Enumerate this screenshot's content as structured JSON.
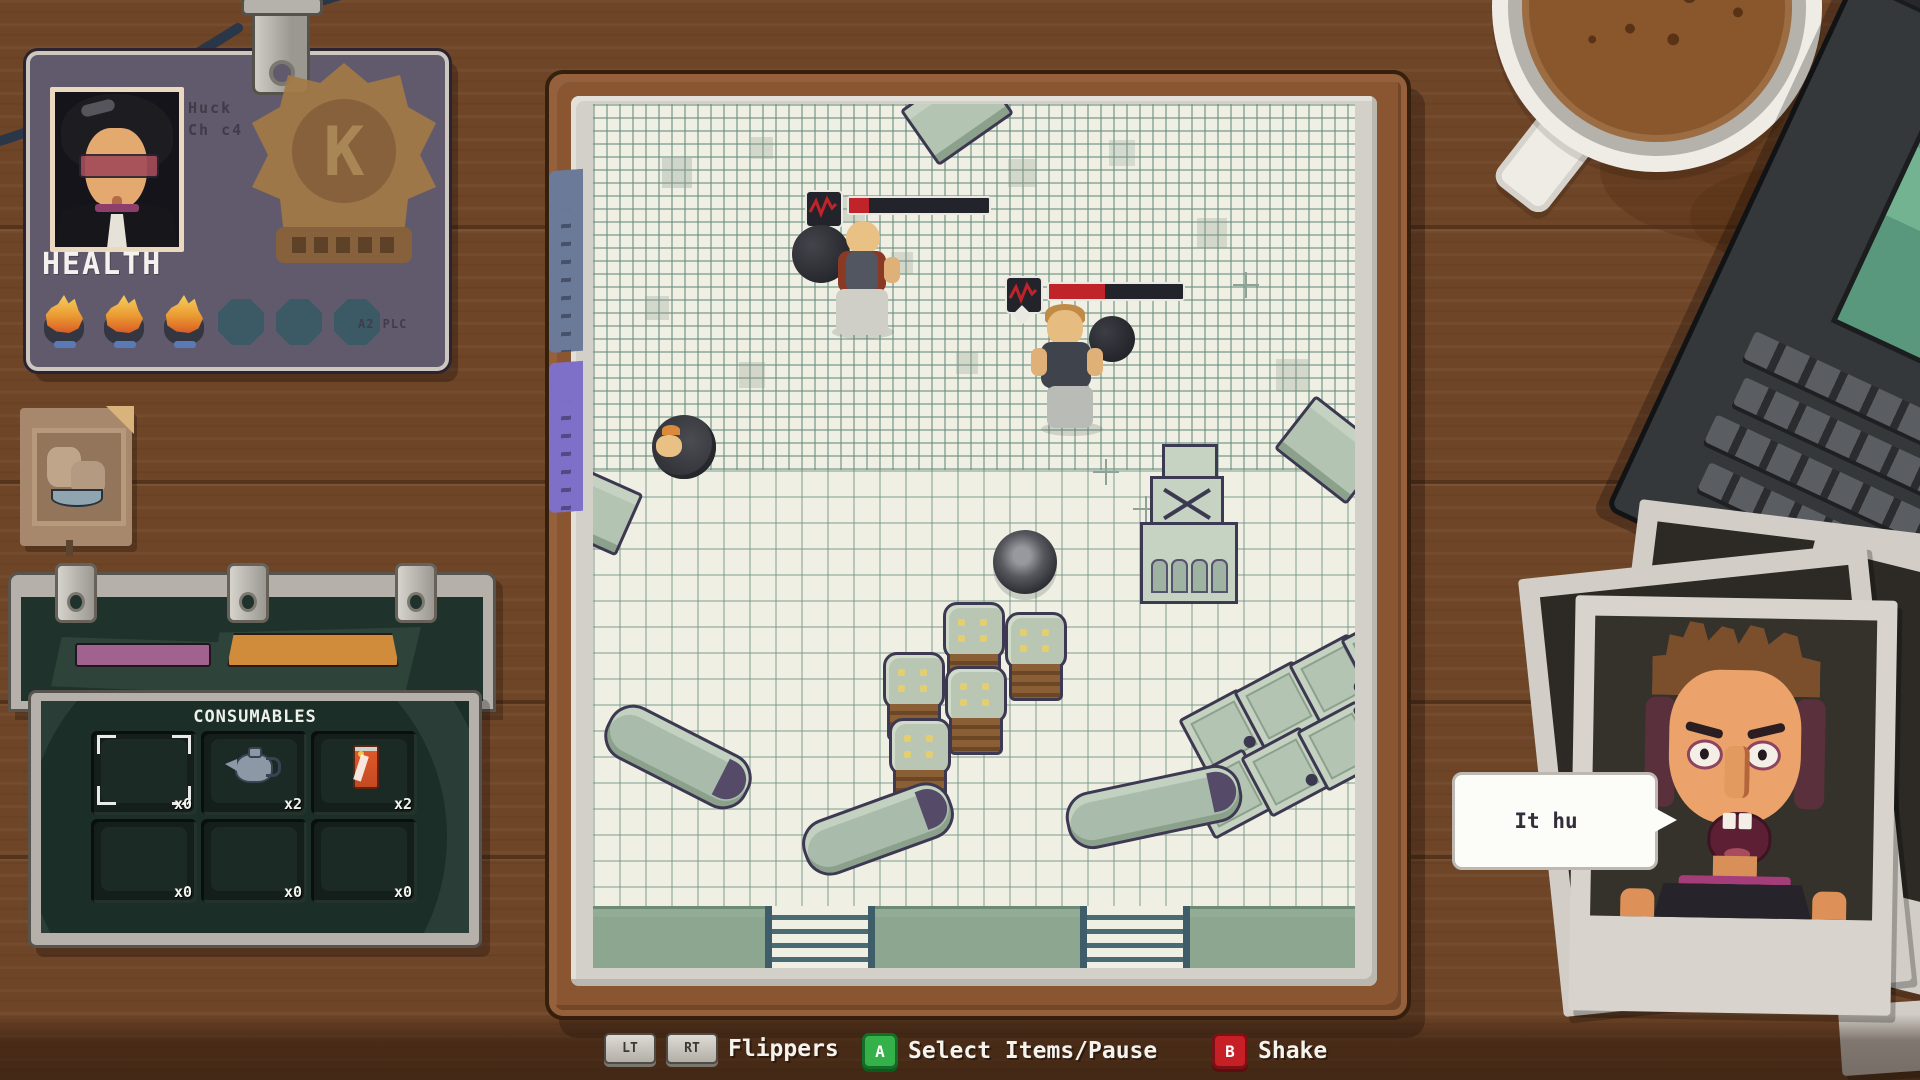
{
  "badge": {
    "name_line1": "Huck",
    "name_line2": "Ch c4",
    "health_label": "HEALTH",
    "health_current": 3,
    "health_max": 6,
    "footer_text": "A2 PLC",
    "emblem_letter": "K"
  },
  "consumables": {
    "title": "CONSUMABLES",
    "slots": [
      {
        "item": "empty",
        "selected": true,
        "count_label": "x0"
      },
      {
        "item": "kettle",
        "selected": false,
        "count_label": "x2"
      },
      {
        "item": "soda-can",
        "selected": false,
        "count_label": "x2"
      },
      {
        "item": "empty",
        "selected": false,
        "count_label": "x0"
      },
      {
        "item": "empty",
        "selected": false,
        "count_label": "x0"
      },
      {
        "item": "empty",
        "selected": false,
        "count_label": "x0"
      }
    ]
  },
  "board": {
    "surface": "graph-paper",
    "enemies": [
      {
        "name": "bald-brawler-with-flail",
        "health_pct": 14
      },
      {
        "name": "blond-brawler-with-ball",
        "health_pct": 42
      }
    ],
    "props": [
      "rolled-enemy-ball",
      "cannonball",
      "crate-tower",
      "barrel-stack",
      "crate-staircase",
      "flippers",
      "ladders",
      "bottom-ledge"
    ]
  },
  "speech": {
    "text": "It hu"
  },
  "controls": {
    "groups": [
      {
        "keys": [
          "LT",
          "RT"
        ],
        "label": "Flippers"
      },
      {
        "keys": [
          "A"
        ],
        "label": "Select Items/Pause"
      },
      {
        "keys": [
          "B"
        ],
        "label": "Shake"
      }
    ]
  },
  "colors": {
    "desk_wood": "#6f4527",
    "paper": "#eff0e3",
    "grid_line": "#7e9a8e",
    "felt_green": "#1c2e28",
    "badge_purple": "#615a6c",
    "health_red": "#c0232a",
    "button_green": "#35b14a",
    "button_red": "#c61f26",
    "band_green": "#8ca690"
  }
}
